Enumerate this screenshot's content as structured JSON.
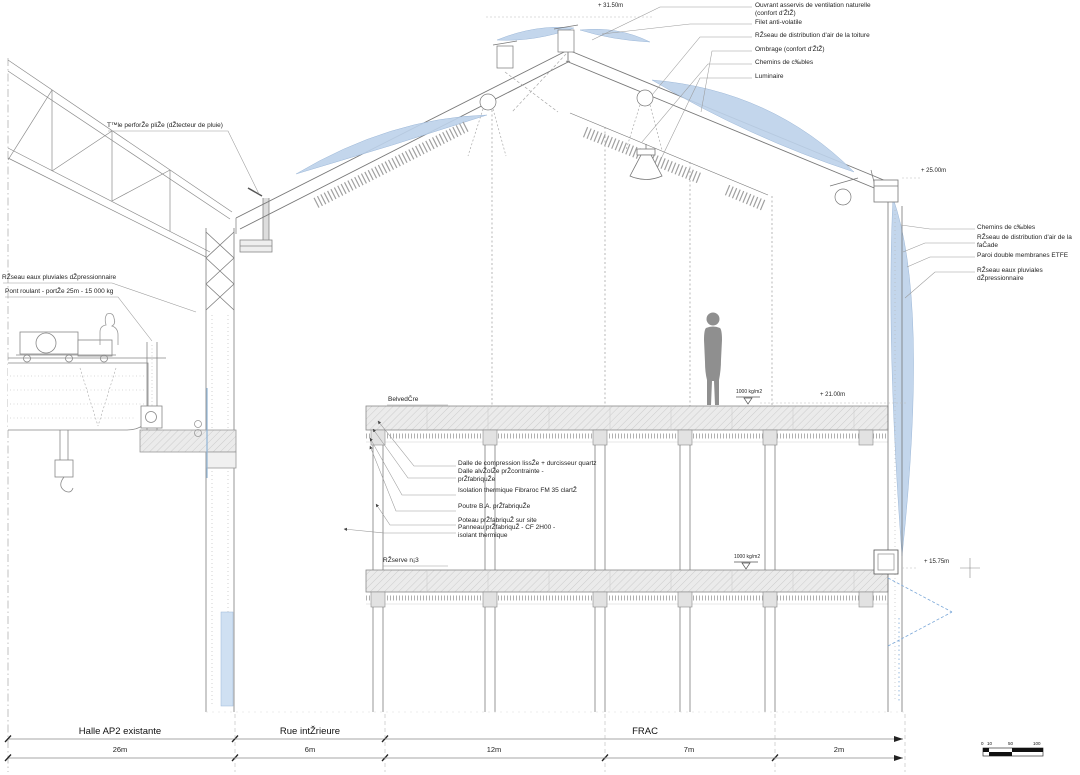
{
  "colors": {
    "etfe_blue": "#bcd1ea",
    "line_gray": "#7d7d7d",
    "slab_gray": "#ebebeb",
    "door_blue": "#7aa7d8"
  },
  "annotations": {
    "top_right": [
      "Ouvrant asservis de ventilation naturelle (confort d'ŽtŽ)",
      "Filet anti-volatile",
      "RŽseau de distribution d'air de la toiture",
      "Ombrage (confort d'ŽtŽ)",
      "Chemins de c‰bles",
      "Luminaire"
    ],
    "right_side": [
      "Chemins de c‰bles",
      "RŽseau de distribution d'air de la faČade",
      "Paroi double membranes ETFE",
      "RŽseau eaux pluviales dŽpressionnaire"
    ],
    "left_side": [
      "T™le perforŽe pliŽe (dŽtecteur de pluie)",
      "RŽseau eaux pluviales dŽpressionnaire",
      "Pont roulant - portŽe 25m - 15 000 kg"
    ],
    "construction": [
      "Dalle de compression lissŽe + durcisseur quartz",
      "Dalle alvŽolŽe prŽcontrainte - prŽfabriquŽe",
      "Isolation thermique Fibraroc FM 35 clartŽ",
      "Poutre B.A. prŽfabriquŽe",
      "Poteau prŽfabriquŽ sur site",
      "Panneau prŽfabriquŽ - CF 2H00 - isolant thermique"
    ],
    "floors": [
      "BelvedČre",
      "RŽserve n¡3"
    ],
    "levels": [
      "+ 31.50m",
      "+ 25.00m",
      "+ 21.00m",
      "+ 15.75m"
    ],
    "loads": [
      "1000 kg/m2",
      "1000 kg/m2"
    ]
  },
  "dimensions": {
    "zones": [
      "Halle AP2 existante",
      "Rue intŽrieure",
      "FRAC"
    ],
    "spans": [
      "26m",
      "6m",
      "12m",
      "7m",
      "2m"
    ]
  },
  "scale_bar": {
    "ticks": [
      "0",
      "10",
      "50",
      "100"
    ]
  }
}
